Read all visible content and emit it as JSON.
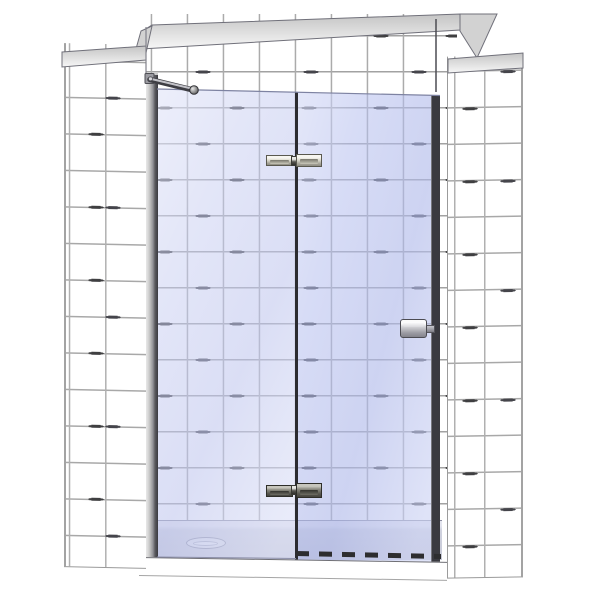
{
  "scene": {
    "description": "3D product rendering of a frameless hinged shower door with an inline fixed glass panel, installed in a white tiled alcove over a low shower tray",
    "view": "front elevation with slight perspective",
    "visible_text": ""
  },
  "components": {
    "scene_figure": "Shower door product rendering",
    "left_tiled_wall": "Left tiled side wall",
    "back_tiled_wall": "Back tiled wall",
    "right_tiled_wall": "Right tiled side wall",
    "wall_cap": "Wall top cap band",
    "left_wall_cap": "Left wall top cap",
    "right_wall_cap": "Right wall top cap",
    "wall_profile": "Wall mounting profile",
    "support_bar": "Diagonal glass support bar",
    "support_bar_knob": "Support bar end connector",
    "support_bar_bracket": "Support bar wall bracket",
    "fixed_panel": "Fixed glass side panel",
    "door_panel": "Hinged glass door panel",
    "pivot_line": "Glass-to-glass pivot joint",
    "door_edge_profile": "Door closing edge profile",
    "top_hinge": "Top glass-to-glass hinge",
    "bottom_hinge": "Bottom glass-to-glass hinge",
    "door_handle": "Door knob handle",
    "bottom_sweep": "Door bottom water-seal sweep",
    "shower_tray": "Low profile shower tray",
    "drain_cover": "Tray waste cover",
    "tray_front": "Tray front apron",
    "glass_top_edge": "Glass top edge",
    "fixed_panel_bottom_edge": "Fixed panel bottom seal",
    "corner_left": "Left alcove corner",
    "corner_right": "Right alcove corner"
  },
  "colors": {
    "background": "#ffffff",
    "tile": "#ffffff",
    "grout": "#a8a8a8",
    "grout_dark_dash": "#3f3f41",
    "wall_cap": "#d2d2d2",
    "glass_fixed_tint": "#dfe3f6",
    "glass_door_tint": "#d8ddf3",
    "glass_edge_dark": "#3a3a40",
    "pivot_line": "#2c2c30",
    "hinge_metal_light": "#f7f6f0",
    "hinge_metal_dark": "#45443e",
    "handle_metal": "#9d9da4",
    "profile_light": "#f0f0f0",
    "profile_dark": "#3b3b40",
    "tray_surface": "#cfd1de",
    "tray_front": "#ffffff",
    "sweep_dark": "#2d2d2f"
  },
  "counts": {
    "hinges": 2,
    "glass_panels": 2,
    "handles": 1,
    "support_bars": 1
  }
}
